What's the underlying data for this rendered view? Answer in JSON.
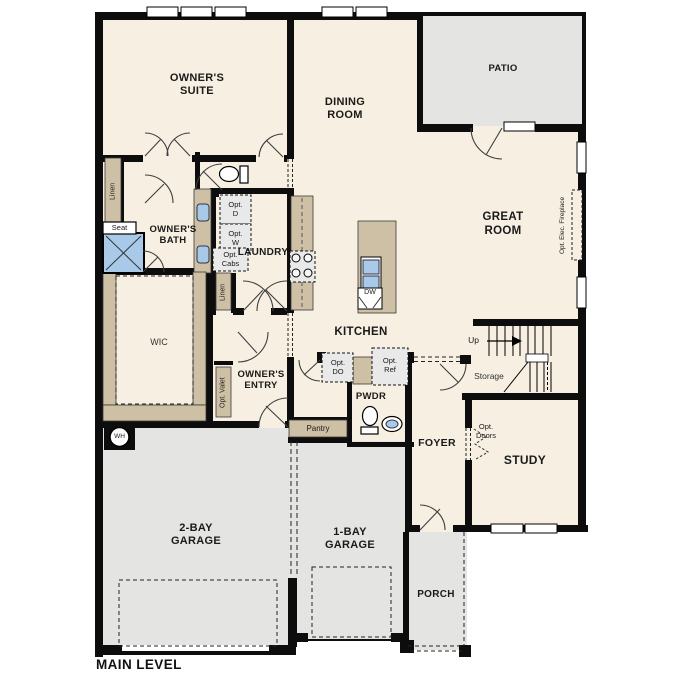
{
  "title": "MAIN LEVEL",
  "rooms": {
    "owners_suite": "OWNER'S SUITE",
    "dining": "DINING ROOM",
    "patio": "PATIO",
    "great_room": "GREAT ROOM",
    "owners_bath": "OWNER'S BATH",
    "wic": "WIC",
    "laundry": "LAUNDRY",
    "owners_entry": "OWNER'S ENTRY",
    "kitchen": "KITCHEN",
    "pwdr": "PWDR",
    "foyer": "FOYER",
    "study": "STUDY",
    "storage": "Storage",
    "garage_2bay": "2-BAY GARAGE",
    "garage_1bay": "1-BAY GARAGE",
    "porch": "PORCH"
  },
  "labels": {
    "linen": "Linen",
    "seat": "Seat",
    "pantry": "Pantry",
    "up": "Up",
    "dw": "DW",
    "wh": "WH",
    "opt_d": "Opt. D",
    "opt_w": "Opt. W",
    "opt_cabs": "Opt. Cabs",
    "opt_valet": "Opt. Valet",
    "opt_do": "Opt. DO",
    "opt_ref": "Opt. Ref",
    "opt_doors": "Opt. Doors",
    "opt_fireplace": "Opt. Elec. Fireplace"
  },
  "colors": {
    "floor": "#f7f0e2",
    "exterior_concrete": "#e4e4e2",
    "cabinetry": "#cec0a4",
    "fixture_blue": "#a9c9e9",
    "wall": "#0d0d0d"
  }
}
